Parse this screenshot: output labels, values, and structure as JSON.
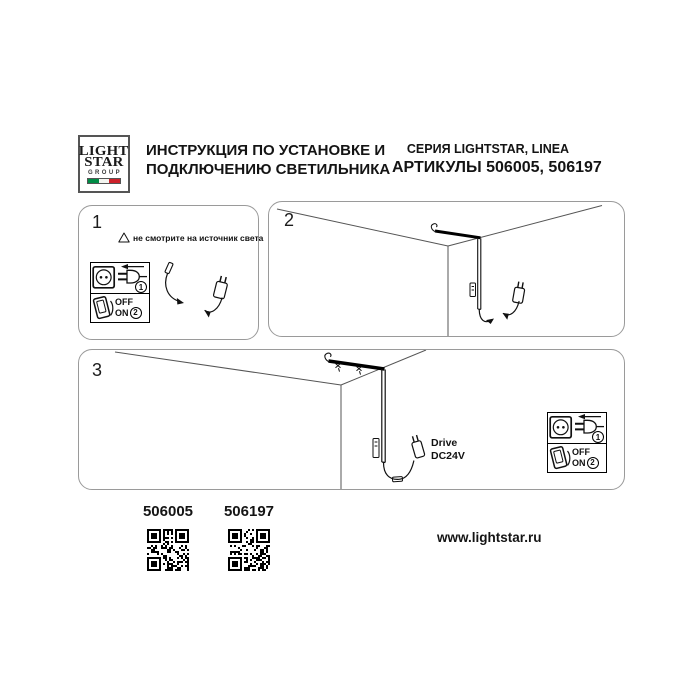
{
  "header": {
    "logo_word1": "LIGHT",
    "logo_word2": "STAR",
    "logo_word3": "GROUP",
    "title_line1": "ИНСТРУКЦИЯ ПО УСТАНОВКЕ И",
    "title_line2": "ПОДКЛЮЧЕНИЮ СВЕТИЛЬНИКА",
    "series_line": "СЕРИЯ LIGHTSTAR, LINEA",
    "articles_line": "АРТИКУЛЫ 506005, 506197"
  },
  "steps": {
    "one": {
      "number": "1",
      "warning_text": "не смотрите на источник света"
    },
    "two": {
      "number": "2"
    },
    "three": {
      "number": "3",
      "drive_line1": "Drive",
      "drive_line2": "DC24V"
    }
  },
  "legend": {
    "plug_step_number": "1",
    "off_label": "OFF",
    "on_label": "ON",
    "switch_step_number": "2"
  },
  "icons": {
    "warning": "triangle-outline",
    "socket": "eu-wall-socket",
    "plug": "power-plug-with-arrow",
    "switch": "rocker-switch"
  },
  "footer": {
    "article_left": "506005",
    "article_right": "506197",
    "website": "www.lightstar.ru"
  },
  "colors": {
    "flag_green": "#008C45",
    "flag_white": "#F4F5F0",
    "flag_red": "#CD212A",
    "panel_border": "#9a9a9a",
    "ink": "#111111"
  }
}
